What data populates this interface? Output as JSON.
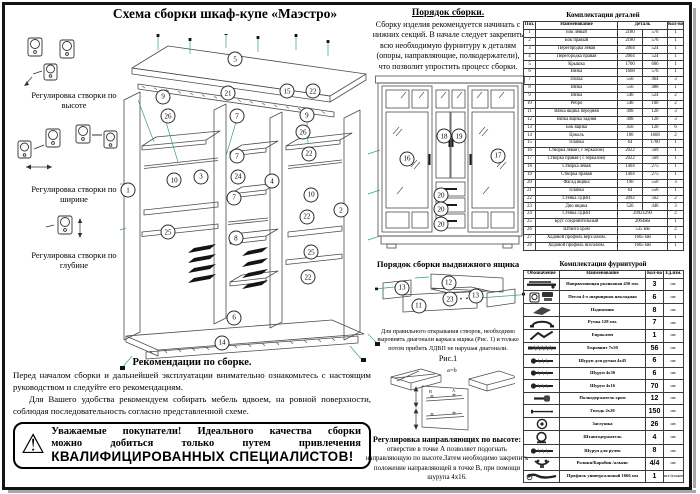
{
  "page": {
    "title": "Схема сборки шкаф-купе «Маэстро»"
  },
  "left_panel": {
    "adjustments": [
      {
        "label": "Регулировка створки по высоте"
      },
      {
        "label": "Регулировка створки по ширине"
      },
      {
        "label": "Регулировка створки по глубине"
      }
    ]
  },
  "assembly_order": {
    "heading": "Порядок сборки.",
    "text": "Сборку изделия рекомендуется начинать с нижних секций. В начале следует закрепить всю необходимую фурнитуру к деталям (опоры, направляющие, полкодержатели), что позволит упростить процесс сборки."
  },
  "main_diagram": {
    "callouts": [
      {
        "n": "5",
        "x": 44.7,
        "y": 7.4
      },
      {
        "n": "21",
        "x": 42,
        "y": 17.5
      },
      {
        "n": "15",
        "x": 64.5,
        "y": 16.9
      },
      {
        "n": "22",
        "x": 74.4,
        "y": 16.9
      },
      {
        "n": "9",
        "x": 17.2,
        "y": 18.6
      },
      {
        "n": "26",
        "x": 19.1,
        "y": 24.3
      },
      {
        "n": "7",
        "x": 45.4,
        "y": 24.3
      },
      {
        "n": "9",
        "x": 72.1,
        "y": 24
      },
      {
        "n": "26",
        "x": 70.6,
        "y": 29
      },
      {
        "n": "22",
        "x": 72.9,
        "y": 35.5
      },
      {
        "n": "7",
        "x": 45.4,
        "y": 36.1
      },
      {
        "n": "3",
        "x": 31.7,
        "y": 42.3
      },
      {
        "n": "24",
        "x": 45.8,
        "y": 42.3
      },
      {
        "n": "4",
        "x": 58.8,
        "y": 43.5
      },
      {
        "n": "10",
        "x": 21.4,
        "y": 43.2
      },
      {
        "n": "1",
        "x": 3.8,
        "y": 46.2
      },
      {
        "n": "7",
        "x": 44.3,
        "y": 48.5
      },
      {
        "n": "10",
        "x": 73.7,
        "y": 47.6
      },
      {
        "n": "22",
        "x": 72.1,
        "y": 54.1
      },
      {
        "n": "2",
        "x": 85.1,
        "y": 52.1
      },
      {
        "n": "25",
        "x": 19.1,
        "y": 58.6
      },
      {
        "n": "8",
        "x": 45,
        "y": 60.4
      },
      {
        "n": "25",
        "x": 73.7,
        "y": 64.5
      },
      {
        "n": "22",
        "x": 72.5,
        "y": 71.9
      },
      {
        "n": "6",
        "x": 44.3,
        "y": 84
      },
      {
        "n": "14",
        "x": 39.7,
        "y": 91.4
      }
    ]
  },
  "front_view": {
    "callouts": [
      {
        "n": "16",
        "x": 21.3,
        "y": 47
      },
      {
        "n": "18",
        "x": 46,
        "y": 34.6
      },
      {
        "n": "19",
        "x": 56,
        "y": 34.6
      },
      {
        "n": "17",
        "x": 82,
        "y": 45.4
      },
      {
        "n": "20",
        "x": 44,
        "y": 66.5
      },
      {
        "n": "20",
        "x": 44,
        "y": 74.1
      },
      {
        "n": "20",
        "x": 44,
        "y": 82.2
      }
    ]
  },
  "drawer_section": {
    "heading": "Порядок сборки выдвижного ящика",
    "callouts": [
      {
        "n": "13",
        "x": 18,
        "y": 32
      },
      {
        "n": "12",
        "x": 49,
        "y": 23
      },
      {
        "n": "23",
        "x": 50,
        "y": 52
      },
      {
        "n": "13",
        "x": 67,
        "y": 46
      },
      {
        "n": "11",
        "x": 29,
        "y": 64
      }
    ],
    "note": "Для правильного открывания створок, необходимо выровнять диагонали каркаса ящика (Рис. 1) и только потом прибить ЛДВП не нарушая диагонали.",
    "fig_label": "Рис.1",
    "fig_eq": "а=b"
  },
  "rail_adjustment": {
    "heading": "Регулировка направляющих по высоте:",
    "text": "отверстие в точке А позволяет подогнать направляющую по высоте.Затем необходимо закрепить положение направляющей в точке В, при помощи шурупа 4х16.",
    "point_a": "А",
    "point_b": "В"
  },
  "recommendations": {
    "heading": "Рекомендации по сборке.",
    "para1": "Перед началом сборки и дальнейшей эксплуатации внимательно ознакомьтесь с настоящим руководством и следуйте его рекомендациям.",
    "para2": "Для Вашего удобства рекомендуем собирать мебель вдвоем, на ровной поверхности, соблюдая последовательность согласно представленной схеме."
  },
  "warning": {
    "line1": "Уважаемые покупатели! Идеального качества сборки",
    "line2": "можно добиться только путем привлечения",
    "line3": "КВАЛИФИЦИРОВАННЫХ СПЕЦИАЛИСТОВ!"
  },
  "parts_table": {
    "title": "Комплектация деталей",
    "headers": [
      "Поз.",
      "Наименование",
      "Деталь",
      "Кол-во"
    ],
    "rows": [
      [
        "1",
        "Бок левый",
        "2180",
        "576",
        "1"
      ],
      [
        "2",
        "Бок правый",
        "2180",
        "576",
        "1"
      ],
      [
        "3",
        "Перегородка левая",
        "2064",
        "524",
        "1"
      ],
      [
        "4",
        "Перегородка правая",
        "2064",
        "524",
        "1"
      ],
      [
        "5",
        "Крышка",
        "1700",
        "606",
        "1"
      ],
      [
        "6",
        "Вязка",
        "1668",
        "576",
        "1"
      ],
      [
        "7",
        "Полка",
        "556",
        "464",
        "3"
      ],
      [
        "8",
        "Вязка",
        "556",
        "488",
        "1"
      ],
      [
        "9",
        "Вязка",
        "540",
        "524",
        "2"
      ],
      [
        "10",
        "Ребро",
        "540",
        "100",
        "2"
      ],
      [
        "11",
        "Вязка ящика передняя",
        "498",
        "120",
        "3"
      ],
      [
        "12",
        "Вязка ящика задняя",
        "498",
        "120",
        "3"
      ],
      [
        "13",
        "Бок ящика",
        "450",
        "120",
        "6"
      ],
      [
        "14",
        "Цоколь",
        "100",
        "1668",
        "2"
      ],
      [
        "15",
        "Планка",
        "64",
        "1700",
        "1"
      ],
      [
        "16",
        "Створка левая ( с зеркалом)",
        "2022",
        "569",
        "1"
      ],
      [
        "17",
        "Створка правая ( с зеркалом)",
        "2022",
        "569",
        "1"
      ],
      [
        "18",
        "Створка левая",
        "1404",
        "275",
        "1"
      ],
      [
        "19",
        "Створка правая",
        "1404",
        "275",
        "1"
      ],
      [
        "20",
        "Фасад ящика",
        "190",
        "550",
        "3"
      ],
      [
        "21",
        "Планка",
        "64",
        "556",
        "1"
      ],
      [
        "22",
        "Стенка ЛДВП",
        "2092",
        "562",
        "2"
      ],
      [
        "23",
        "Дно ящика",
        "526",
        "446",
        "3"
      ],
      [
        "24",
        "Стенка ЛДВП",
        "2092х290",
        "2"
      ],
      [
        "25",
        "Брус соединительный",
        "2064мм",
        "1"
      ],
      [
        "26",
        "Штанга хром",
        "535 мм",
        "2"
      ],
      [
        "27",
        "Ходовой профиль верх/алюм.",
        "1665 мм",
        "1"
      ],
      [
        "28",
        "Ходовой профиль низ/алюм.",
        "1665 мм",
        "1"
      ]
    ]
  },
  "hardware_table": {
    "title": "Комплектация фурнитурой",
    "headers": [
      "Обозначение",
      "Наименование",
      "Кол-во",
      "Ед.изм."
    ],
    "rows": [
      {
        "icon": "rail-icon",
        "name": "Направляющая роликовая 450 мм.",
        "qty": "3",
        "unit": "шт."
      },
      {
        "icon": "hinge-icon",
        "name": "Петля 4-х шарнирная накладная",
        "qty": "6",
        "unit": "шт."
      },
      {
        "icon": "foot-icon",
        "name": "Подпятник",
        "qty": "8",
        "unit": "шт."
      },
      {
        "icon": "handle-icon",
        "name": "Ручка 128 мм.",
        "qty": "7",
        "unit": "шт."
      },
      {
        "icon": "hexkey-icon",
        "name": "Евроключ",
        "qty": "1",
        "unit": "шт."
      },
      {
        "icon": "confirmat-icon",
        "name": "Евровинт 7х50",
        "qty": "56",
        "unit": "шт."
      },
      {
        "icon": "screw-icon",
        "name": "Шуруп для ручки 4х45",
        "qty": "6",
        "unit": "шт."
      },
      {
        "icon": "screw-icon",
        "name": "Шуруп 4х30",
        "qty": "6",
        "unit": "шт."
      },
      {
        "icon": "screw-icon",
        "name": "Шуруп 4х16",
        "qty": "70",
        "unit": "шт."
      },
      {
        "icon": "shelf-pin-icon",
        "name": "Полкодержатель  хром",
        "qty": "12",
        "unit": "шт."
      },
      {
        "icon": "nail-icon",
        "name": "Гвоздь 2х20",
        "qty": "150",
        "unit": "шт."
      },
      {
        "icon": "cap-icon",
        "name": "Заглушка",
        "qty": "26",
        "unit": "шт."
      },
      {
        "icon": "rod-holder-icon",
        "name": "Штангодержатель",
        "qty": "4",
        "unit": "шт."
      },
      {
        "icon": "screw-icon",
        "name": "Шуруп для ручек",
        "qty": "8",
        "unit": "шт."
      },
      {
        "icon": "roller-icon",
        "name": "Ролики/Карабин /альянс",
        "qty": "4/4",
        "unit": "шт."
      },
      {
        "icon": "profile-icon",
        "name": "Профиль универсальный 1666 мм",
        "qty": "1",
        "unit": "шт./альянс"
      }
    ]
  },
  "colors": {
    "accent_teal": "#2f9e9a",
    "line": "#4c4c4c"
  }
}
